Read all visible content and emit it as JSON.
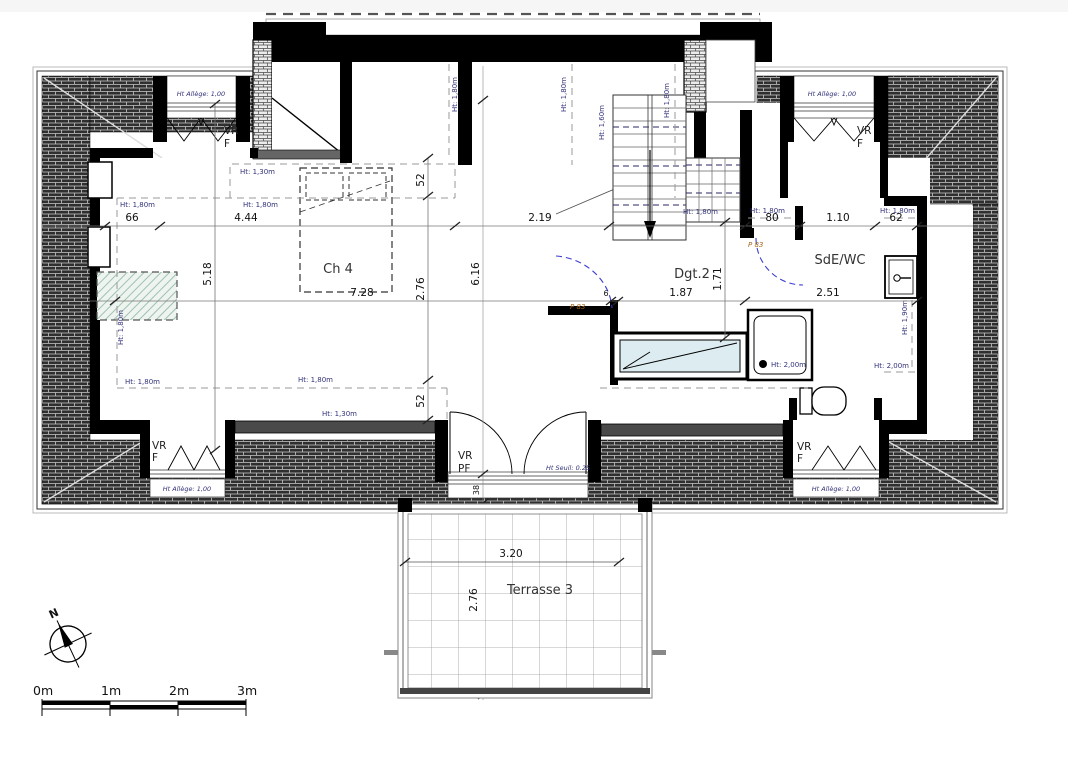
{
  "meta": {
    "type": "architectural floor plan, attic level with terrace",
    "language": "fr"
  },
  "colors": {
    "wall": "#000000",
    "roof_hatch": "#2f2f2f",
    "height_label": "#33337a",
    "door_ref_label": "#a5681e",
    "door_swing": "#3b3bd1",
    "bathtub_fill": "#dcecf0",
    "velux_hatch": "#9fc0b0"
  },
  "rooms": {
    "ch4": "Ch 4",
    "dgt2": "Dgt.2",
    "sde_wc": "SdE/WC",
    "terrasse": "Terrasse 3"
  },
  "openings": {
    "vr": "VR",
    "f": "F",
    "pf": "PF",
    "door_ref": "P 83"
  },
  "annotations": {
    "h130": "Ht: 1,30m",
    "h160": "Ht: 1,60m",
    "h180": "Ht: 1,80m",
    "h190": "Ht: 1,90m",
    "h200": "Ht: 2,00m",
    "allege": "Ht Allège: 1,00",
    "seuil": "Ht Seuil: 0.25"
  },
  "dimensions": {
    "top_chain": [
      "66",
      "4.44",
      "2.19",
      "80",
      "1.10",
      "62"
    ],
    "mid_chain": [
      "7.28",
      "6",
      "1.87",
      "2.51"
    ],
    "v_left": "5.18",
    "v_52_top": "52",
    "v_276": "2.76",
    "v_52_bottom": "52",
    "v_616": "6.16",
    "v_171": "1.71",
    "v_38": "38",
    "terrace_w": "3.20",
    "terrace_h": "2.76"
  },
  "compass": {
    "north": "N"
  },
  "scale_bar": {
    "labels": [
      "0m",
      "1m",
      "2m",
      "3m"
    ]
  }
}
